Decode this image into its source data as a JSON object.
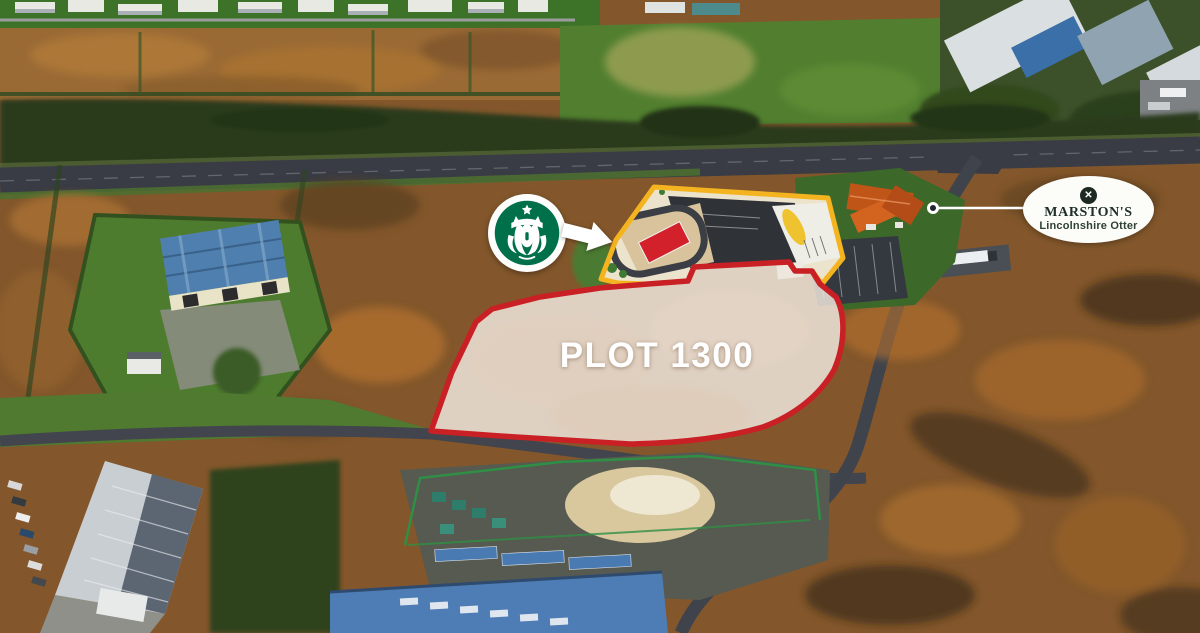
{
  "page": {
    "description": "Aerial marketing photograph of a roadside development site with annotated plots",
    "width_px": 1200,
    "height_px": 633
  },
  "plots": {
    "plot_1300": {
      "label": "PLOT 1300",
      "outline_color": "#c92026",
      "fill_color": "rgba(239,230,221,0.85)"
    },
    "starbucks_unit": {
      "outline_color": "#f4b41f",
      "building_color": "#d2212b"
    }
  },
  "annotations": {
    "starbucks": {
      "icon": "starbucks-siren-logo",
      "brand_green": "#00704a"
    },
    "arrow": {
      "icon": "arrow-right-icon",
      "color": "#ffffff"
    },
    "marstons": {
      "name": "MARSTON'S",
      "subtitle": "Lincolnshire Otter",
      "emblem_icon": "marstons-cross-emblem",
      "emblem_glyph": "✕",
      "text_color": "#1d2f26",
      "leader_color": "#ffffff"
    }
  }
}
